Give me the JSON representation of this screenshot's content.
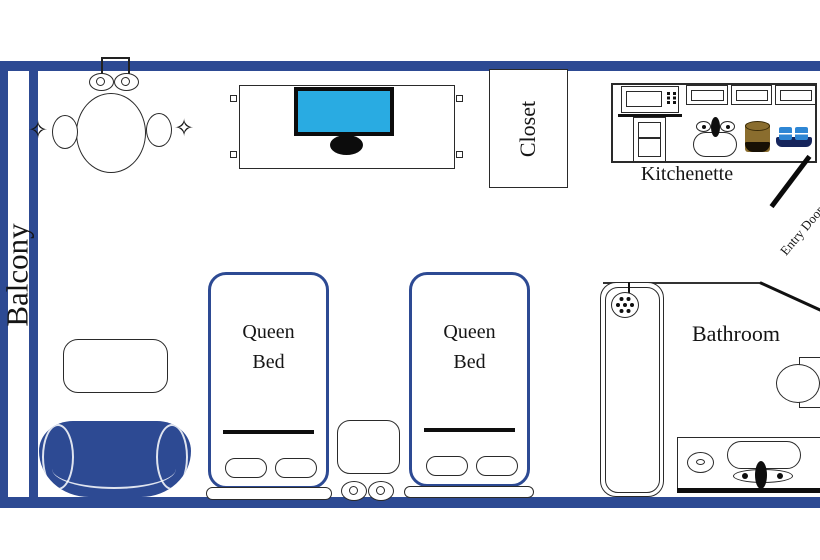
{
  "rooms": {
    "balcony": {
      "label": "Balcony"
    },
    "closet": {
      "label": "Closet"
    },
    "kitchenette": {
      "label": "Kitchenette"
    },
    "bathroom": {
      "label": "Bathroom"
    },
    "entry": {
      "label": "Entry Door"
    }
  },
  "furniture": {
    "bed_1": {
      "line1": "Queen",
      "line2": "Bed"
    },
    "bed_2": {
      "line1": "Queen",
      "line2": "Bed"
    }
  },
  "decor": {
    "sparkle": "✧"
  },
  "colors": {
    "wall": "#2d4a93",
    "tv-screen": "#29abe2",
    "sofa": "#2d4a93",
    "stroke": "#2a2a2a",
    "coffee": "#8a6d2e",
    "coffee-dark": "#171004",
    "mug": "#2e86d4",
    "mug-base": "#16255c"
  }
}
